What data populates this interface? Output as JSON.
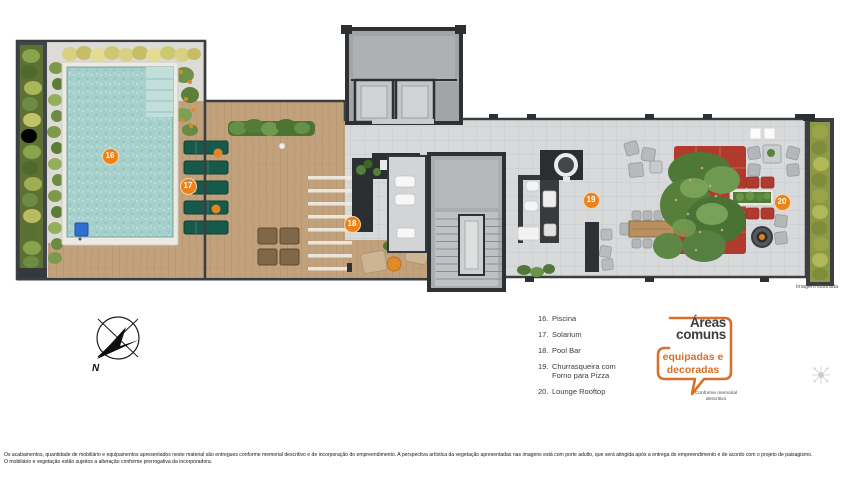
{
  "plan": {
    "caption": "Imagem ilustrada",
    "markers": [
      {
        "label": "16"
      },
      {
        "label": "17"
      },
      {
        "label": "18"
      },
      {
        "label": "19"
      },
      {
        "label": "20"
      }
    ]
  },
  "legend": {
    "items": [
      {
        "number": "16.",
        "label": "Piscina"
      },
      {
        "number": "17.",
        "label": "Solarium"
      },
      {
        "number": "18.",
        "label": "Pool Bar"
      },
      {
        "number": "19.",
        "label": "Churrasqueira com Forno para Pizza"
      },
      {
        "number": "20.",
        "label": "Lounge Rooftop"
      }
    ]
  },
  "badge": {
    "title_line1": "Áreas",
    "title_line2": "comuns",
    "subtitle_line1": "equipadas e",
    "subtitle_line2": "decoradas",
    "note": "Conforme memorial descritivo"
  },
  "compass": {
    "north_label": "N"
  },
  "footer": {
    "disclaimer_line1": "Os acabamentos, quantidade de mobiliário e equipamentos apresentados neste material são entregues conforme memorial descritivo e de incorporação do empreendimento. A perspectiva artística da vegetação apresentadas nas imagens está com porte adulto, que será atingida após a entrega do empreendimento e de acordo com o projeto de paisagismo.",
    "disclaimer_line2": "O mobiliário e vegetação estão sujeitos a alteração conforme prerrogativa da incorporadora."
  },
  "colors": {
    "accent_orange": "#D96F28",
    "marker_orange": "#EC8218",
    "pool_water": "#A6D0CC",
    "deck_wood": "#C2A27C",
    "sofa_red": "#B13A2E",
    "lounger_green": "#175A4C",
    "wall_dark": "#2E3134"
  }
}
